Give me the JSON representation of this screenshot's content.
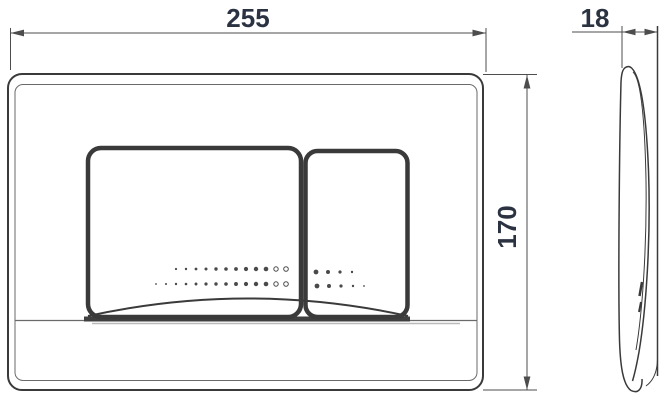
{
  "drawing": {
    "dimensions": {
      "width": "255",
      "depth": "18",
      "height": "170"
    },
    "colors": {
      "line": "#3a3a3a",
      "thin_line": "#6a6a6a",
      "dim_line": "#4d4d4d",
      "dim_text": "#2b3342",
      "dot": "#4a4a4a",
      "background": "#ffffff"
    }
  }
}
